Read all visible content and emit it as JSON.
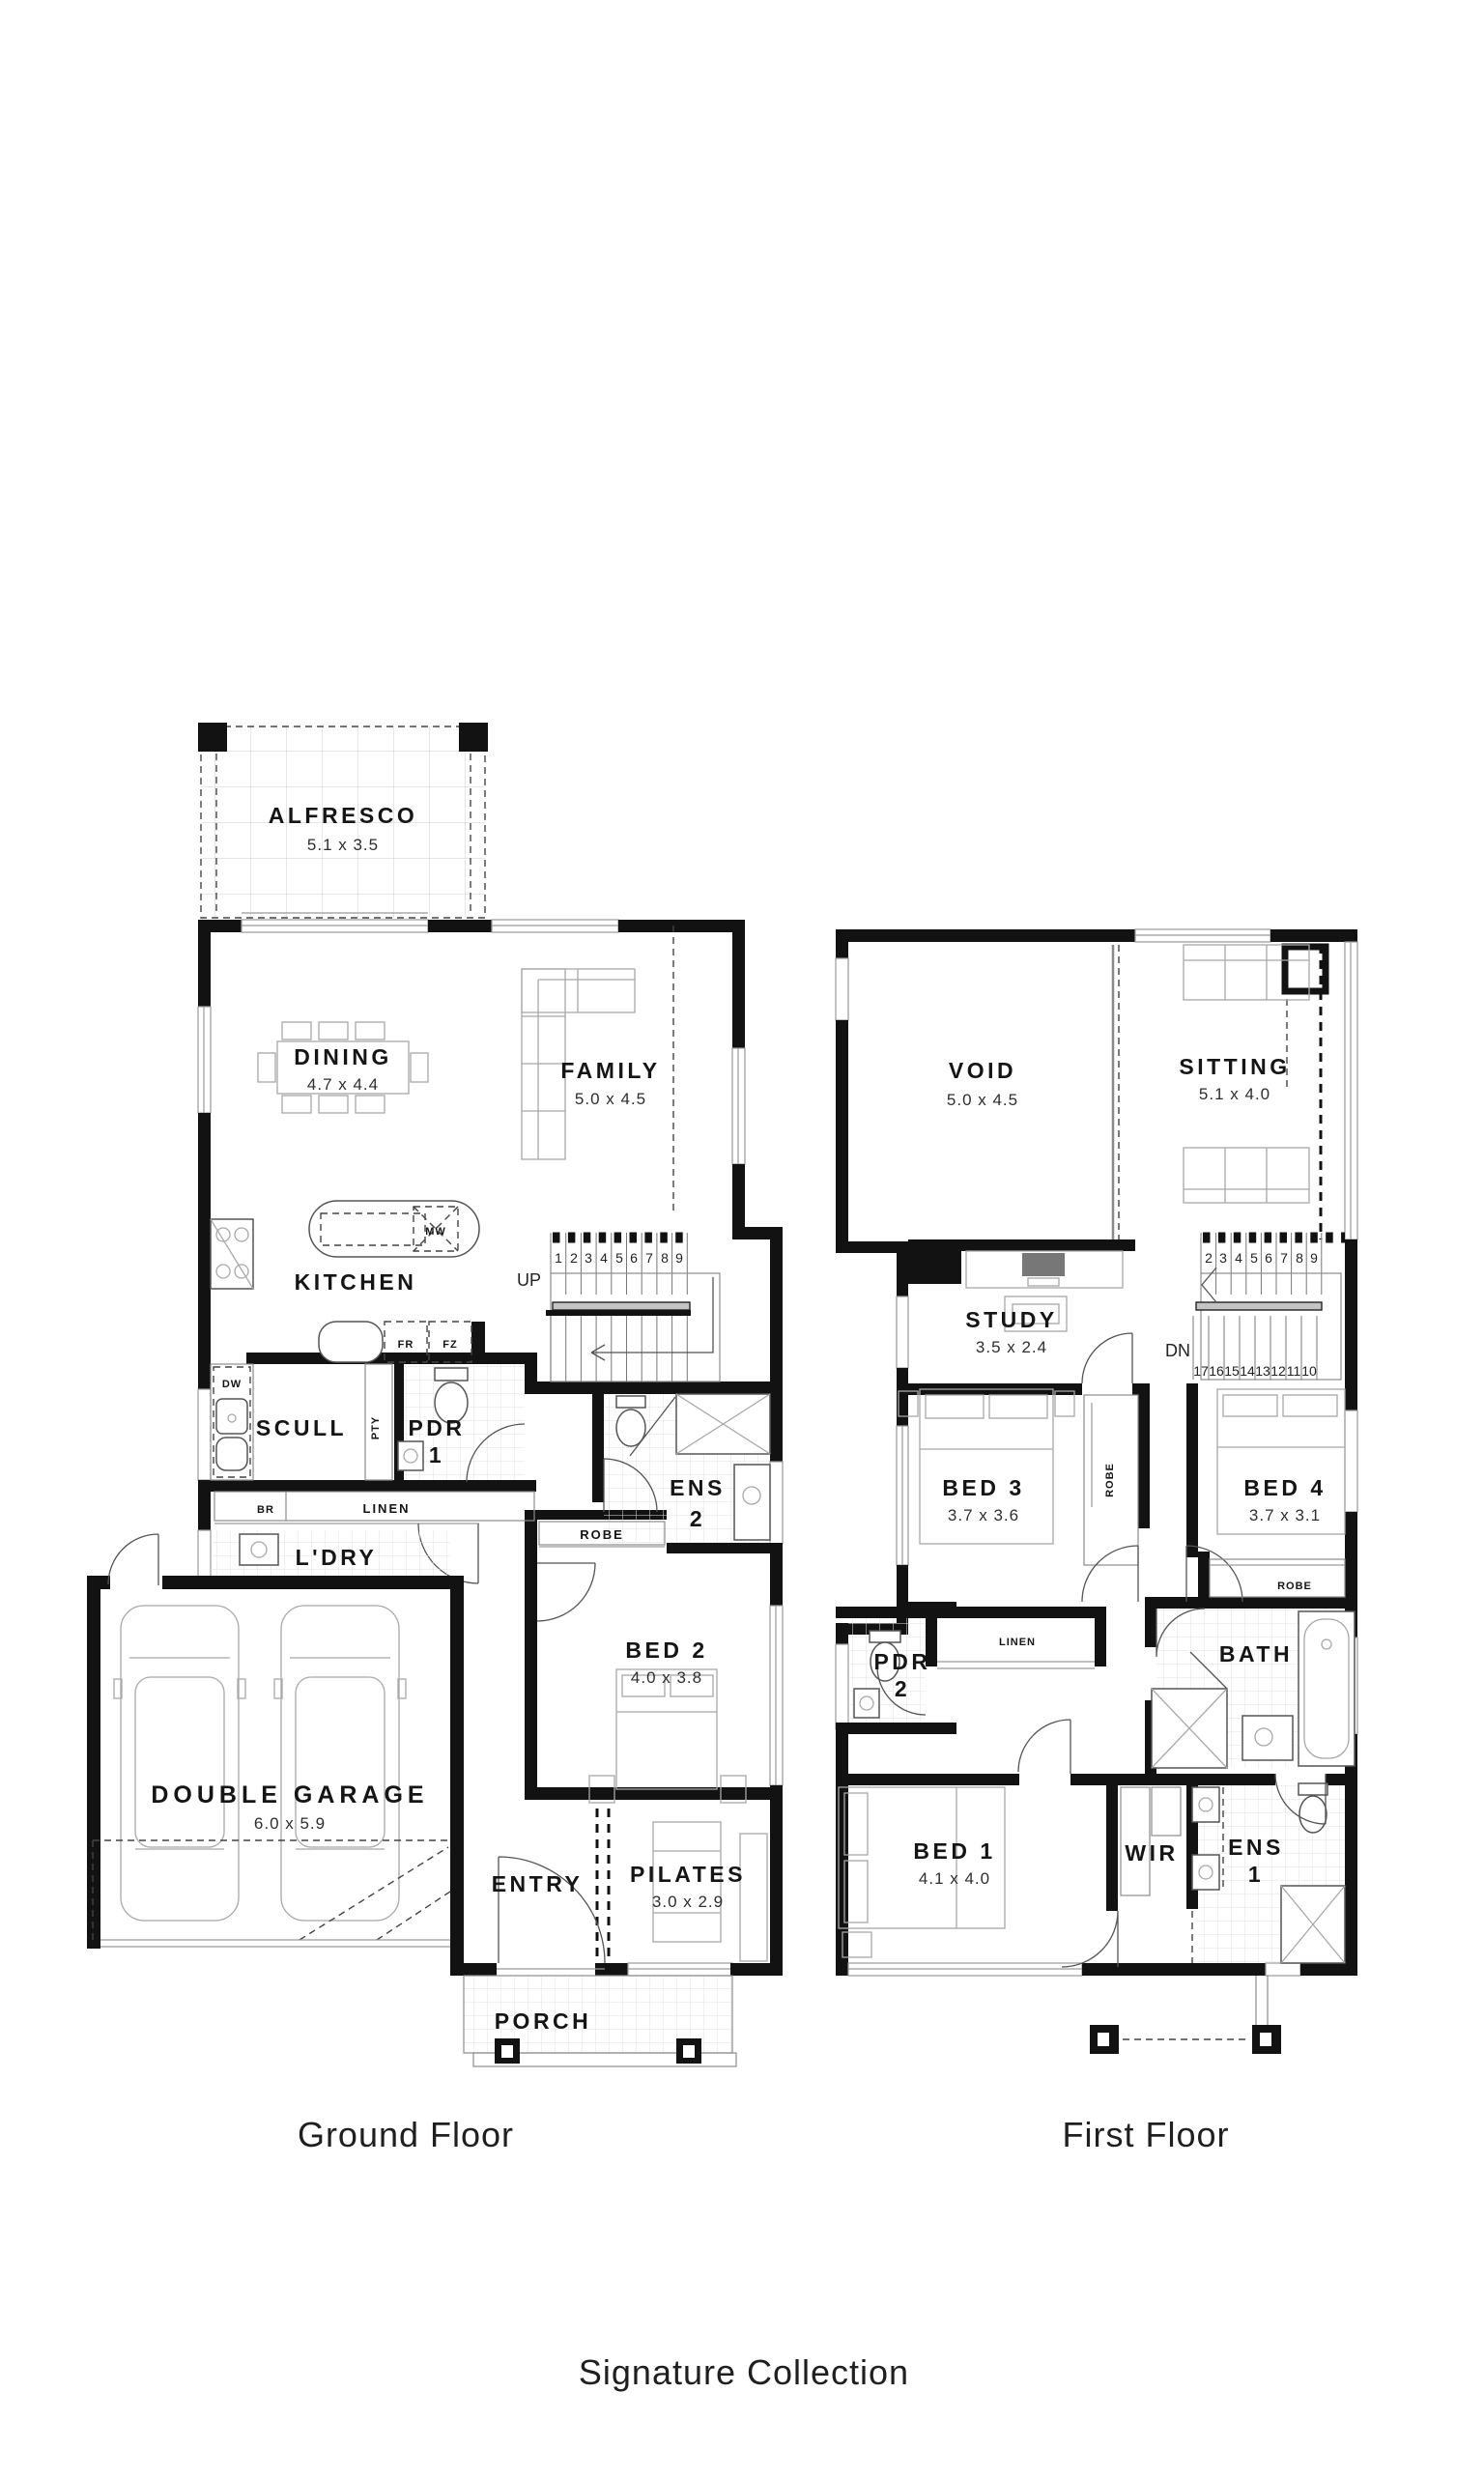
{
  "title": {
    "collection": "Signature Collection"
  },
  "floors": {
    "ground": {
      "caption": "Ground Floor",
      "rooms": {
        "alfresco": {
          "name": "ALFRESCO",
          "dim": "5.1 x 3.5"
        },
        "dining": {
          "name": "DINING",
          "dim": "4.7 x 4.4"
        },
        "family": {
          "name": "FAMILY",
          "dim": "5.0 x 4.5"
        },
        "kitchen": {
          "name": "KITCHEN"
        },
        "scull": {
          "name": "SCULL"
        },
        "pantry": {
          "name": "PTY"
        },
        "pdr1": {
          "name": "PDR",
          "number": "1"
        },
        "ens2": {
          "name": "ENS",
          "number": "2"
        },
        "robe": {
          "name": "ROBE"
        },
        "br": {
          "name": "BR"
        },
        "linen": {
          "name": "LINEN"
        },
        "laundry": {
          "name": "L'DRY"
        },
        "bed2": {
          "name": "BED 2",
          "dim": "4.0 x 3.8"
        },
        "garage": {
          "name": "DOUBLE GARAGE",
          "dim": "6.0 x 5.9"
        },
        "entry": {
          "name": "ENTRY"
        },
        "pilates": {
          "name": "PILATES",
          "dim": "3.0 x 2.9"
        },
        "porch": {
          "name": "PORCH"
        }
      },
      "appliances": {
        "mw": "MW",
        "fr": "FR",
        "fz": "FZ",
        "dw": "DW"
      },
      "stairs": {
        "direction": "UP",
        "numbers": [
          "1",
          "2",
          "3",
          "4",
          "5",
          "6",
          "7",
          "8",
          "9"
        ]
      }
    },
    "first": {
      "caption": "First Floor",
      "rooms": {
        "void": {
          "name": "VOID",
          "dim": "5.0 x 4.5"
        },
        "sitting": {
          "name": "SITTING",
          "dim": "5.1 x 4.0"
        },
        "study": {
          "name": "STUDY",
          "dim": "3.5 x 2.4"
        },
        "bed3": {
          "name": "BED 3",
          "dim": "3.7 x 3.6"
        },
        "bed4": {
          "name": "BED 4",
          "dim": "3.7 x 3.1"
        },
        "robe3": {
          "name": "ROBE"
        },
        "robe4": {
          "name": "ROBE"
        },
        "pdr2": {
          "name": "PDR",
          "number": "2"
        },
        "linen": {
          "name": "LINEN"
        },
        "bath": {
          "name": "BATH"
        },
        "bed1": {
          "name": "BED 1",
          "dim": "4.1 x 4.0"
        },
        "wir": {
          "name": "WIR"
        },
        "ens1": {
          "name": "ENS",
          "number": "1"
        }
      },
      "stairs": {
        "direction": "DN",
        "numbers_up": [
          "2",
          "3",
          "4",
          "5",
          "6",
          "7",
          "8",
          "9"
        ],
        "numbers_down": [
          "17",
          "16",
          "15",
          "14",
          "13",
          "12",
          "11",
          "10"
        ]
      }
    }
  },
  "colors": {
    "wall": "#121212",
    "fixture_line": "#9a9a9a",
    "tile_line": "#e2e2e2"
  }
}
